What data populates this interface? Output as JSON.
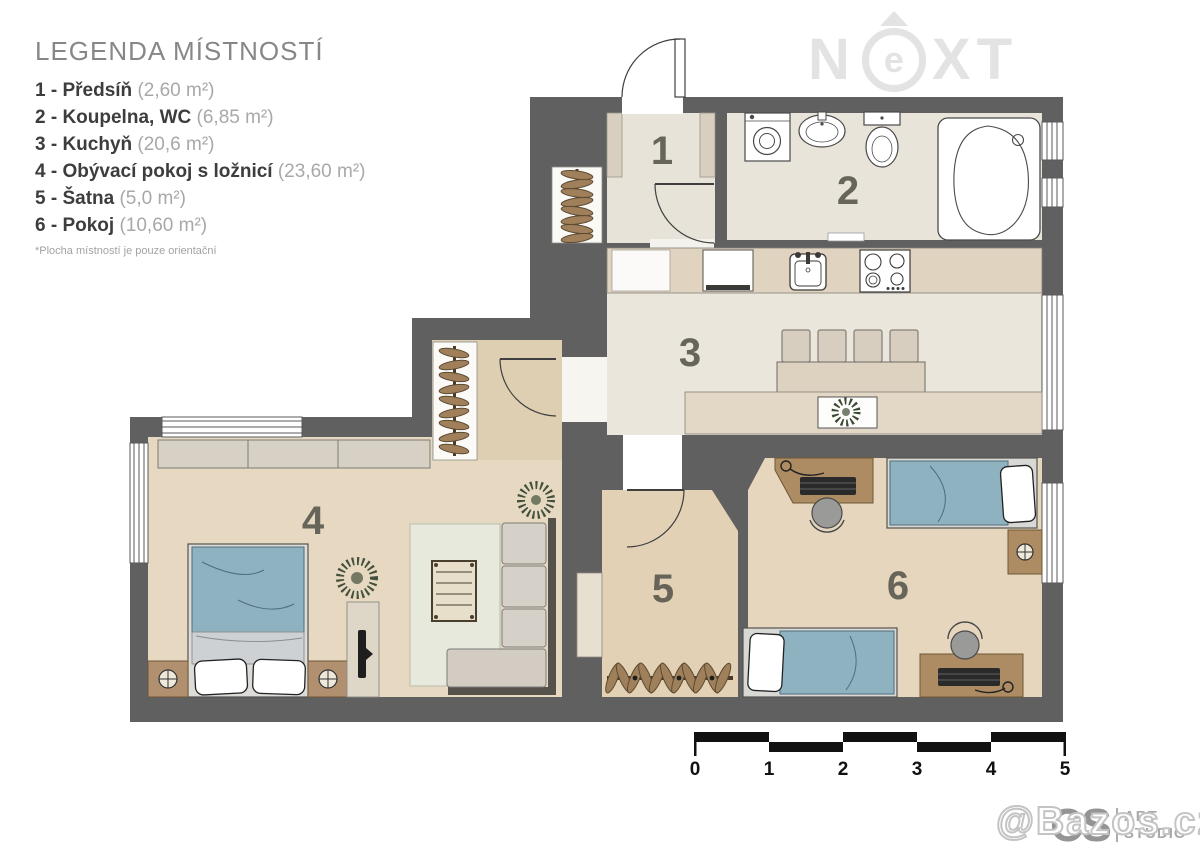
{
  "legend": {
    "title": "LEGENDA MÍSTNOSTÍ",
    "items": [
      {
        "label": "1 - Předsíň",
        "area": "(2,60 m²)"
      },
      {
        "label": "2 - Koupelna, WC",
        "area": "(6,85 m²)"
      },
      {
        "label": "3 - Kuchyň",
        "area": "(20,6 m²)"
      },
      {
        "label": "4 - Obývací pokoj s ložnicí",
        "area": "(23,60 m²)"
      },
      {
        "label": "5 - Šatna",
        "area": "(5,0 m²)"
      },
      {
        "label": "6 - Pokoj",
        "area": "(10,60 m²)"
      }
    ],
    "footnote": "*Plocha místností je pouze orientační"
  },
  "plan": {
    "room_labels": [
      "1",
      "2",
      "3",
      "4",
      "5",
      "6"
    ],
    "scale_labels": [
      "0",
      "1",
      "2",
      "3",
      "4",
      "5"
    ]
  },
  "watermarks": {
    "next_n": "N",
    "next_e": "e",
    "next_x": "X",
    "next_t": "T",
    "bazos": "@Bazos.cz",
    "studio_main": "CS",
    "studio_line1": "ART",
    "studio_line2": "STUDIO"
  },
  "colors": {
    "wall": "#606060",
    "tile_floor": "#e8e4da",
    "wood_floor": "#e7d9c1",
    "bed_blue": "#8fb2c1",
    "furniture_brown": "#ae8c63",
    "rug": "#e7e9dd"
  }
}
